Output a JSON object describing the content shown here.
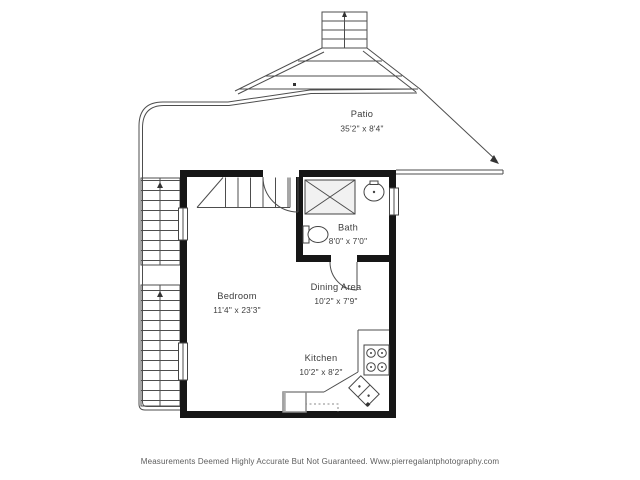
{
  "rooms": [
    {
      "name": "Patio",
      "dims": "35'2\" x 8'4\""
    },
    {
      "name": "Bath",
      "dims": "8'0\" x 7'0\""
    },
    {
      "name": "Bedroom",
      "dims": "11'4\" x 23'3\""
    },
    {
      "name": "Dining Area",
      "dims": "10'2\" x 7'9\""
    },
    {
      "name": "Kitchen",
      "dims": "10'2\" x 8'2\""
    }
  ],
  "footer": {
    "disclaimer": "Measurements Deemed Highly Accurate But Not Guaranteed. Www.pierregalantphotography.com"
  },
  "fixtures": [
    "shower",
    "bathroom-sink",
    "toilet",
    "entry-door",
    "bath-door",
    "interior-stairs",
    "exterior-stairs",
    "top-deck-stairs",
    "stove",
    "kitchen-sink",
    "dishwasher",
    "windows",
    "patio-railings"
  ],
  "colors": {
    "background": "#ffffff",
    "wall": "#161616",
    "line": "#4d4d4d",
    "room_text": "#3d3d3d",
    "footer_text": "#5c5c5c",
    "shower_fill": "#f1f1f1"
  }
}
